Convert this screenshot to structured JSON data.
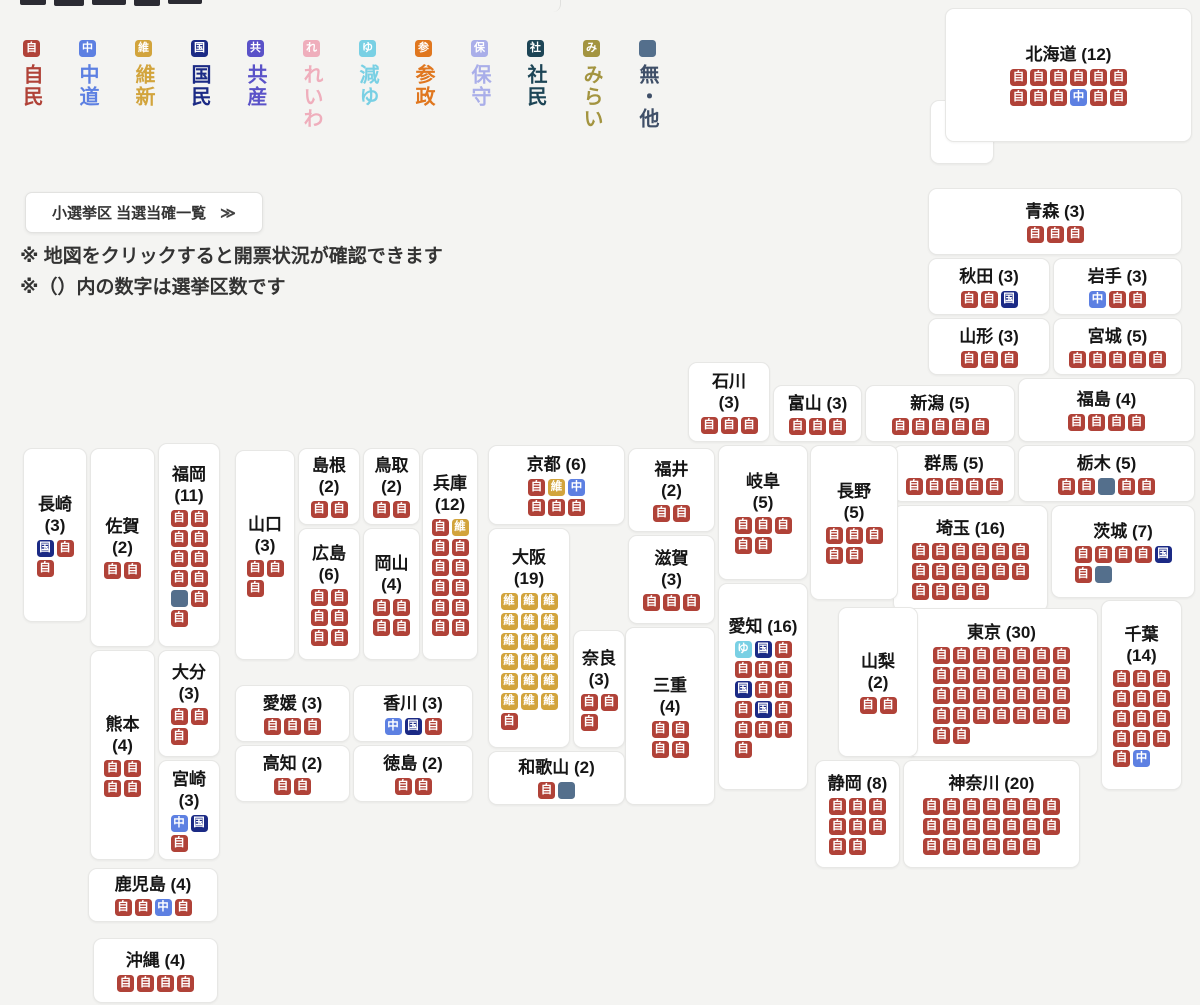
{
  "parties": {
    "jimin": {
      "char": "自",
      "color": "#b04238",
      "label": "自民"
    },
    "chudo": {
      "char": "中",
      "color": "#5d80e2",
      "label": "中道"
    },
    "ishin": {
      "char": "維",
      "color": "#d2a43c",
      "label": "維新"
    },
    "kokumin": {
      "char": "国",
      "color": "#1b2a85",
      "label": "国民"
    },
    "kyosan": {
      "char": "共",
      "color": "#5a52c8",
      "label": "共産"
    },
    "reiwa": {
      "char": "れ",
      "color": "#efaebc",
      "label": "れいわ"
    },
    "genyu": {
      "char": "ゆ",
      "color": "#79d0e4",
      "label": "減ゆ"
    },
    "sansei": {
      "char": "参",
      "color": "#e0771f",
      "label": "参政"
    },
    "hoshu": {
      "char": "保",
      "color": "#a9aee9",
      "label": "保守"
    },
    "shamin": {
      "char": "社",
      "color": "#1d4556",
      "label": "社民"
    },
    "mirai": {
      "char": "み",
      "color": "#a39440",
      "label": "みらい"
    },
    "mu": {
      "char": "",
      "color": "#546f8c",
      "label": "無・他",
      "label_color": "#3f4f68"
    }
  },
  "legend": {
    "order": [
      "jimin",
      "chudo",
      "ishin",
      "kokumin",
      "kyosan",
      "reiwa",
      "genyu",
      "sansei",
      "hoshu",
      "shamin",
      "mirai",
      "mu"
    ]
  },
  "toolbar": {
    "list_button_label": "小選挙区 当選当確一覧",
    "list_button_arrow": "≫"
  },
  "notes": [
    "※ 地図をクリックすると開票状況が確認できます",
    "※（）内の数字は選挙区数です"
  ],
  "map": {
    "prefectures": [
      {
        "id": "hokkaido",
        "name": "北海道",
        "seats": 12,
        "stacked": false,
        "per_row": 6,
        "box": [
          945,
          8,
          247,
          134
        ],
        "badges": [
          "jimin",
          "jimin",
          "jimin",
          "jimin",
          "jimin",
          "jimin",
          "jimin",
          "jimin",
          "jimin",
          "chudo",
          "jimin",
          "jimin"
        ]
      },
      {
        "id": "aomori",
        "name": "青森",
        "seats": 3,
        "stacked": false,
        "per_row": 3,
        "box": [
          928,
          188,
          254,
          67
        ],
        "badges": [
          "jimin",
          "jimin",
          "jimin"
        ]
      },
      {
        "id": "akita",
        "name": "秋田",
        "seats": 3,
        "stacked": false,
        "per_row": 3,
        "box": [
          928,
          258,
          122,
          57
        ],
        "badges": [
          "jimin",
          "jimin",
          "kokumin"
        ]
      },
      {
        "id": "iwate",
        "name": "岩手",
        "seats": 3,
        "stacked": false,
        "per_row": 3,
        "box": [
          1053,
          258,
          129,
          57
        ],
        "badges": [
          "chudo",
          "jimin",
          "jimin"
        ]
      },
      {
        "id": "yamagata",
        "name": "山形",
        "seats": 3,
        "stacked": false,
        "per_row": 3,
        "box": [
          928,
          318,
          122,
          57
        ],
        "badges": [
          "jimin",
          "jimin",
          "jimin"
        ]
      },
      {
        "id": "miyagi",
        "name": "宮城",
        "seats": 5,
        "stacked": false,
        "per_row": 5,
        "box": [
          1053,
          318,
          129,
          57
        ],
        "badges": [
          "jimin",
          "jimin",
          "jimin",
          "jimin",
          "jimin"
        ]
      },
      {
        "id": "ishikawa",
        "name": "石川",
        "seats": 3,
        "stacked": true,
        "per_row": 3,
        "box": [
          688,
          362,
          82,
          80
        ],
        "badges": [
          "jimin",
          "jimin",
          "jimin"
        ]
      },
      {
        "id": "toyama",
        "name": "富山",
        "seats": 3,
        "stacked": false,
        "per_row": 3,
        "box": [
          773,
          385,
          89,
          57
        ],
        "badges": [
          "jimin",
          "jimin",
          "jimin"
        ]
      },
      {
        "id": "niigata",
        "name": "新潟",
        "seats": 5,
        "stacked": false,
        "per_row": 5,
        "box": [
          865,
          385,
          150,
          57
        ],
        "badges": [
          "jimin",
          "jimin",
          "jimin",
          "jimin",
          "jimin"
        ]
      },
      {
        "id": "fukushima",
        "name": "福島",
        "seats": 4,
        "stacked": false,
        "per_row": 4,
        "box": [
          1018,
          378,
          177,
          64
        ],
        "badges": [
          "jimin",
          "jimin",
          "jimin",
          "jimin"
        ]
      },
      {
        "id": "gunma",
        "name": "群馬",
        "seats": 5,
        "stacked": false,
        "per_row": 5,
        "box": [
          893,
          445,
          122,
          57
        ],
        "badges": [
          "jimin",
          "jimin",
          "jimin",
          "jimin",
          "jimin"
        ]
      },
      {
        "id": "tochigi",
        "name": "栃木",
        "seats": 5,
        "stacked": false,
        "per_row": 5,
        "box": [
          1018,
          445,
          177,
          57
        ],
        "badges": [
          "jimin",
          "jimin",
          "mu",
          "jimin",
          "jimin"
        ]
      },
      {
        "id": "saitama",
        "name": "埼玉",
        "seats": 16,
        "stacked": false,
        "per_row": 6,
        "box": [
          893,
          505,
          155,
          107
        ],
        "badges": [
          "jimin",
          "jimin",
          "jimin",
          "jimin",
          "jimin",
          "jimin",
          "jimin",
          "jimin",
          "jimin",
          "jimin",
          "jimin",
          "jimin",
          "jimin",
          "jimin",
          "jimin",
          "jimin"
        ]
      },
      {
        "id": "ibaraki",
        "name": "茨城",
        "seats": 7,
        "stacked": false,
        "per_row": 5,
        "box": [
          1051,
          505,
          144,
          93
        ],
        "badges": [
          "jimin",
          "jimin",
          "jimin",
          "jimin",
          "kokumin",
          "jimin",
          "mu"
        ]
      },
      {
        "id": "tokyo",
        "name": "東京",
        "seats": 30,
        "stacked": false,
        "per_row": 7,
        "box": [
          905,
          608,
          193,
          149
        ],
        "badges": [
          "jimin",
          "jimin",
          "jimin",
          "jimin",
          "jimin",
          "jimin",
          "jimin",
          "jimin",
          "jimin",
          "jimin",
          "jimin",
          "jimin",
          "jimin",
          "jimin",
          "jimin",
          "jimin",
          "jimin",
          "jimin",
          "jimin",
          "jimin",
          "jimin",
          "jimin",
          "jimin",
          "jimin",
          "jimin",
          "jimin",
          "jimin",
          "jimin",
          "jimin",
          "jimin"
        ]
      },
      {
        "id": "chiba",
        "name": "千葉",
        "seats": 14,
        "stacked": true,
        "per_row": 3,
        "box": [
          1101,
          600,
          81,
          190
        ],
        "badges": [
          "jimin",
          "jimin",
          "jimin",
          "jimin",
          "jimin",
          "jimin",
          "jimin",
          "jimin",
          "jimin",
          "jimin",
          "jimin",
          "jimin",
          "jimin",
          "chudo"
        ]
      },
      {
        "id": "kanagawa",
        "name": "神奈川",
        "seats": 20,
        "stacked": false,
        "per_row": 7,
        "box": [
          903,
          760,
          177,
          108
        ],
        "badges": [
          "jimin",
          "jimin",
          "jimin",
          "jimin",
          "jimin",
          "jimin",
          "jimin",
          "jimin",
          "jimin",
          "jimin",
          "jimin",
          "jimin",
          "jimin",
          "jimin",
          "jimin",
          "jimin",
          "jimin",
          "jimin",
          "jimin",
          "jimin"
        ]
      },
      {
        "id": "shizuoka",
        "name": "静岡",
        "seats": 8,
        "stacked": false,
        "per_row": 3,
        "box": [
          815,
          760,
          85,
          108
        ],
        "badges": [
          "jimin",
          "jimin",
          "jimin",
          "jimin",
          "jimin",
          "jimin",
          "jimin",
          "jimin"
        ]
      },
      {
        "id": "yamanashi",
        "name": "山梨",
        "seats": 2,
        "stacked": true,
        "per_row": 2,
        "box": [
          838,
          607,
          80,
          150
        ],
        "badges": [
          "jimin",
          "jimin"
        ]
      },
      {
        "id": "nagano",
        "name": "長野",
        "seats": 5,
        "stacked": true,
        "per_row": 3,
        "box": [
          810,
          445,
          88,
          155
        ],
        "badges": [
          "jimin",
          "jimin",
          "jimin",
          "jimin",
          "jimin"
        ]
      },
      {
        "id": "gifu",
        "name": "岐阜",
        "seats": 5,
        "stacked": true,
        "per_row": 3,
        "box": [
          718,
          445,
          90,
          135
        ],
        "badges": [
          "jimin",
          "jimin",
          "jimin",
          "jimin",
          "jimin"
        ]
      },
      {
        "id": "aichi",
        "name": "愛知",
        "seats": 16,
        "stacked": false,
        "per_row": 3,
        "box": [
          718,
          583,
          90,
          207
        ],
        "badges": [
          "genyu",
          "kokumin",
          "jimin",
          "jimin",
          "jimin",
          "jimin",
          "kokumin",
          "jimin",
          "jimin",
          "jimin",
          "kokumin",
          "jimin",
          "jimin",
          "jimin",
          "jimin",
          "jimin"
        ]
      },
      {
        "id": "fukui",
        "name": "福井",
        "seats": 2,
        "stacked": true,
        "per_row": 2,
        "box": [
          628,
          448,
          87,
          84
        ],
        "badges": [
          "jimin",
          "jimin"
        ]
      },
      {
        "id": "shiga",
        "name": "滋賀",
        "seats": 3,
        "stacked": true,
        "per_row": 3,
        "box": [
          628,
          535,
          87,
          89
        ],
        "badges": [
          "jimin",
          "jimin",
          "jimin"
        ]
      },
      {
        "id": "mie",
        "name": "三重",
        "seats": 4,
        "stacked": true,
        "per_row": 2,
        "box": [
          625,
          627,
          90,
          178
        ],
        "badges": [
          "jimin",
          "jimin",
          "jimin",
          "jimin"
        ]
      },
      {
        "id": "kyoto",
        "name": "京都",
        "seats": 6,
        "stacked": false,
        "per_row": 3,
        "box": [
          488,
          445,
          137,
          80
        ],
        "badges": [
          "jimin",
          "ishin",
          "chudo",
          "jimin",
          "jimin",
          "jimin"
        ]
      },
      {
        "id": "osaka",
        "name": "大阪",
        "seats": 19,
        "stacked": true,
        "per_row": 3,
        "box": [
          488,
          528,
          82,
          220
        ],
        "badges": [
          "ishin",
          "ishin",
          "ishin",
          "ishin",
          "ishin",
          "ishin",
          "ishin",
          "ishin",
          "ishin",
          "ishin",
          "ishin",
          "ishin",
          "ishin",
          "ishin",
          "ishin",
          "ishin",
          "ishin",
          "ishin",
          "jimin"
        ]
      },
      {
        "id": "nara",
        "name": "奈良",
        "seats": 3,
        "stacked": true,
        "per_row": 2,
        "box": [
          573,
          630,
          52,
          118
        ],
        "badges": [
          "jimin",
          "jimin",
          "jimin"
        ]
      },
      {
        "id": "wakayama",
        "name": "和歌山",
        "seats": 2,
        "stacked": false,
        "per_row": 2,
        "box": [
          488,
          751,
          137,
          54
        ],
        "badges": [
          "jimin",
          "mu"
        ]
      },
      {
        "id": "hyogo",
        "name": "兵庫",
        "seats": 12,
        "stacked": true,
        "per_row": 2,
        "box": [
          422,
          448,
          56,
          212
        ],
        "badges": [
          "jimin",
          "ishin",
          "jimin",
          "jimin",
          "jimin",
          "jimin",
          "jimin",
          "jimin",
          "jimin",
          "jimin",
          "jimin",
          "jimin"
        ]
      },
      {
        "id": "tottori",
        "name": "鳥取",
        "seats": 2,
        "stacked": true,
        "per_row": 2,
        "box": [
          363,
          448,
          57,
          77
        ],
        "badges": [
          "jimin",
          "jimin"
        ]
      },
      {
        "id": "shimane",
        "name": "島根",
        "seats": 2,
        "stacked": true,
        "per_row": 2,
        "box": [
          298,
          448,
          62,
          77
        ],
        "badges": [
          "jimin",
          "jimin"
        ]
      },
      {
        "id": "hiroshima",
        "name": "広島",
        "seats": 6,
        "stacked": true,
        "per_row": 2,
        "box": [
          298,
          528,
          62,
          132
        ],
        "badges": [
          "jimin",
          "jimin",
          "jimin",
          "jimin",
          "jimin",
          "jimin"
        ]
      },
      {
        "id": "okayama",
        "name": "岡山",
        "seats": 4,
        "stacked": true,
        "per_row": 2,
        "box": [
          363,
          528,
          57,
          132
        ],
        "badges": [
          "jimin",
          "jimin",
          "jimin",
          "jimin"
        ]
      },
      {
        "id": "yamaguchi",
        "name": "山口",
        "seats": 3,
        "stacked": true,
        "per_row": 2,
        "box": [
          235,
          450,
          60,
          210
        ],
        "badges": [
          "jimin",
          "jimin",
          "jimin"
        ]
      },
      {
        "id": "ehime",
        "name": "愛媛",
        "seats": 3,
        "stacked": false,
        "per_row": 3,
        "box": [
          235,
          685,
          115,
          57
        ],
        "badges": [
          "jimin",
          "jimin",
          "jimin"
        ]
      },
      {
        "id": "kagawa",
        "name": "香川",
        "seats": 3,
        "stacked": false,
        "per_row": 3,
        "box": [
          353,
          685,
          120,
          57
        ],
        "badges": [
          "chudo",
          "kokumin",
          "jimin"
        ]
      },
      {
        "id": "kochi",
        "name": "高知",
        "seats": 2,
        "stacked": false,
        "per_row": 2,
        "box": [
          235,
          745,
          115,
          57
        ],
        "badges": [
          "jimin",
          "jimin"
        ]
      },
      {
        "id": "tokushima",
        "name": "徳島",
        "seats": 2,
        "stacked": false,
        "per_row": 2,
        "box": [
          353,
          745,
          120,
          57
        ],
        "badges": [
          "jimin",
          "jimin"
        ]
      },
      {
        "id": "nagasaki",
        "name": "長崎",
        "seats": 3,
        "stacked": true,
        "per_row": 2,
        "box": [
          23,
          448,
          64,
          174
        ],
        "badges": [
          "kokumin",
          "jimin",
          "jimin"
        ]
      },
      {
        "id": "saga",
        "name": "佐賀",
        "seats": 2,
        "stacked": true,
        "per_row": 2,
        "box": [
          90,
          448,
          65,
          199
        ],
        "badges": [
          "jimin",
          "jimin"
        ]
      },
      {
        "id": "fukuoka",
        "name": "福岡",
        "seats": 11,
        "stacked": true,
        "per_row": 2,
        "box": [
          158,
          443,
          62,
          204
        ],
        "badges": [
          "jimin",
          "jimin",
          "jimin",
          "jimin",
          "jimin",
          "jimin",
          "jimin",
          "jimin",
          "mu",
          "jimin",
          "jimin"
        ]
      },
      {
        "id": "kumamoto",
        "name": "熊本",
        "seats": 4,
        "stacked": true,
        "per_row": 2,
        "box": [
          90,
          650,
          65,
          210
        ],
        "badges": [
          "jimin",
          "jimin",
          "jimin",
          "jimin"
        ]
      },
      {
        "id": "oita",
        "name": "大分",
        "seats": 3,
        "stacked": true,
        "per_row": 2,
        "box": [
          158,
          650,
          62,
          107
        ],
        "badges": [
          "jimin",
          "jimin",
          "jimin"
        ]
      },
      {
        "id": "miyazaki",
        "name": "宮崎",
        "seats": 3,
        "stacked": true,
        "per_row": 2,
        "box": [
          158,
          760,
          62,
          100
        ],
        "badges": [
          "chudo",
          "kokumin",
          "jimin"
        ]
      },
      {
        "id": "kagoshima",
        "name": "鹿児島",
        "seats": 4,
        "stacked": false,
        "per_row": 4,
        "box": [
          88,
          868,
          130,
          54
        ],
        "badges": [
          "jimin",
          "jimin",
          "chudo",
          "jimin"
        ]
      },
      {
        "id": "okinawa",
        "name": "沖縄",
        "seats": 4,
        "stacked": false,
        "per_row": 4,
        "box": [
          93,
          938,
          125,
          65
        ],
        "badges": [
          "jimin",
          "jimin",
          "jimin",
          "jimin"
        ]
      }
    ]
  }
}
